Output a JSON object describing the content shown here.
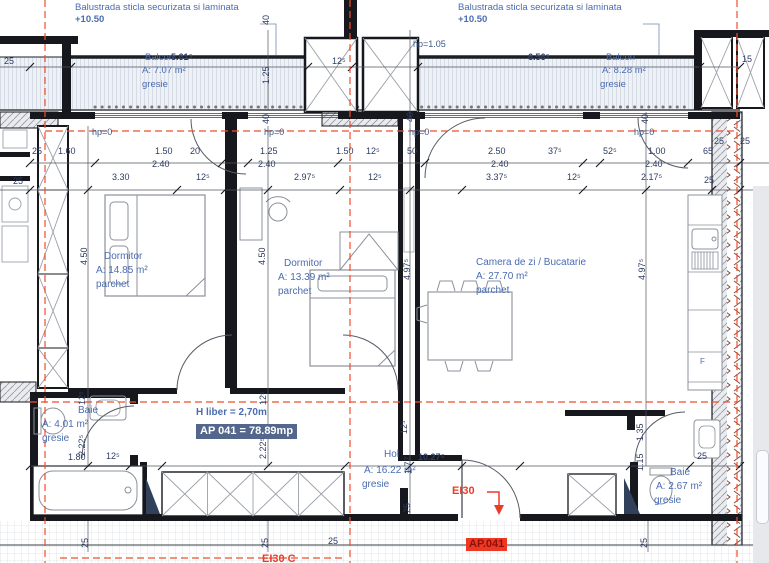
{
  "drawing": {
    "balustrade_left": {
      "line1": "Balustrada sticla securizata si laminata",
      "line2": "+10.50"
    },
    "balustrade_right": {
      "line1": "Balustrada sticla securizata si laminata",
      "line2": "+10.50"
    },
    "balcony_left": {
      "name": "Balcon",
      "length": "5.61⁵",
      "area": "A: 7.07 m²",
      "finish": "gresie"
    },
    "balcony_right": {
      "name": "Balcon",
      "length": "6.56⁵",
      "area": "A: 8.28 m²",
      "finish": "gresie"
    },
    "parapet_balcony": "hp=1.05",
    "parapet_w1": "hp=0",
    "parapet_w2": "hp=0",
    "parapet_w3": "hp=0",
    "parapet_w4": "hp=0",
    "rooms": {
      "dormitor1": {
        "name": "Dormitor",
        "area": "A: 14.85 m²",
        "finish": "parchet"
      },
      "dormitor2": {
        "name": "Dormitor",
        "area": "A: 13.39 m²",
        "finish": "parchet"
      },
      "living": {
        "name": "Camera de zi / Bucatarie",
        "area": "A: 27.70 m²",
        "finish": "parchet"
      },
      "baie1": {
        "name": "Baie",
        "area": "A: 4.01 m²",
        "finish": "gresie"
      },
      "baie2": {
        "name": "Baie",
        "area": "A: 2.67 m²",
        "finish": "gresie"
      },
      "hol": {
        "name": "Hol",
        "length": "10.27⁵",
        "area": "A: 16.22 m²",
        "finish": "gresie"
      }
    },
    "apartment": {
      "ceiling_height": "H liber = 2,70m",
      "total_area": "AP 041 = 78.89mp",
      "unit_badge": "AP.041",
      "entry_fire_rating": "EI30",
      "fire_rating_clipped": "EI30 C"
    },
    "kitchen": {
      "fridge": "F"
    },
    "dims": {
      "h1": [
        "25",
        "1.60",
        "1.50",
        "20",
        "1.25",
        "1.50",
        "12⁵",
        "50",
        "2.50",
        "37⁵",
        "52⁵",
        "1.00",
        "65"
      ],
      "h2": [
        "2.40",
        "2.40",
        "2.40",
        "2.40"
      ],
      "h3": [
        "3.30",
        "12⁵",
        "2.97⁵",
        "12⁵",
        "3.37⁵",
        "12⁵",
        "2.17⁵",
        "25"
      ],
      "top": [
        "25",
        "12⁵",
        "15",
        "25",
        "25"
      ],
      "v": [
        "40",
        "1.25",
        "40",
        "40",
        "40",
        "4.50",
        "4.50",
        "4.97⁵",
        "4.97⁵",
        "12⁵",
        "2.22⁵",
        "12⁵",
        "2.22⁵",
        "12⁵",
        "1.77",
        "25",
        "1.35",
        "1.15",
        "25",
        "25",
        "25"
      ],
      "b": [
        "1.80",
        "12⁵",
        "25",
        "25"
      ],
      "misc": [
        "25"
      ]
    },
    "colors": {
      "annotation_blue": "#4a6cb0",
      "dimension_navy": "#2e3c62",
      "alert_red": "#ea3d28",
      "highlight_slate": "#53668b"
    }
  }
}
